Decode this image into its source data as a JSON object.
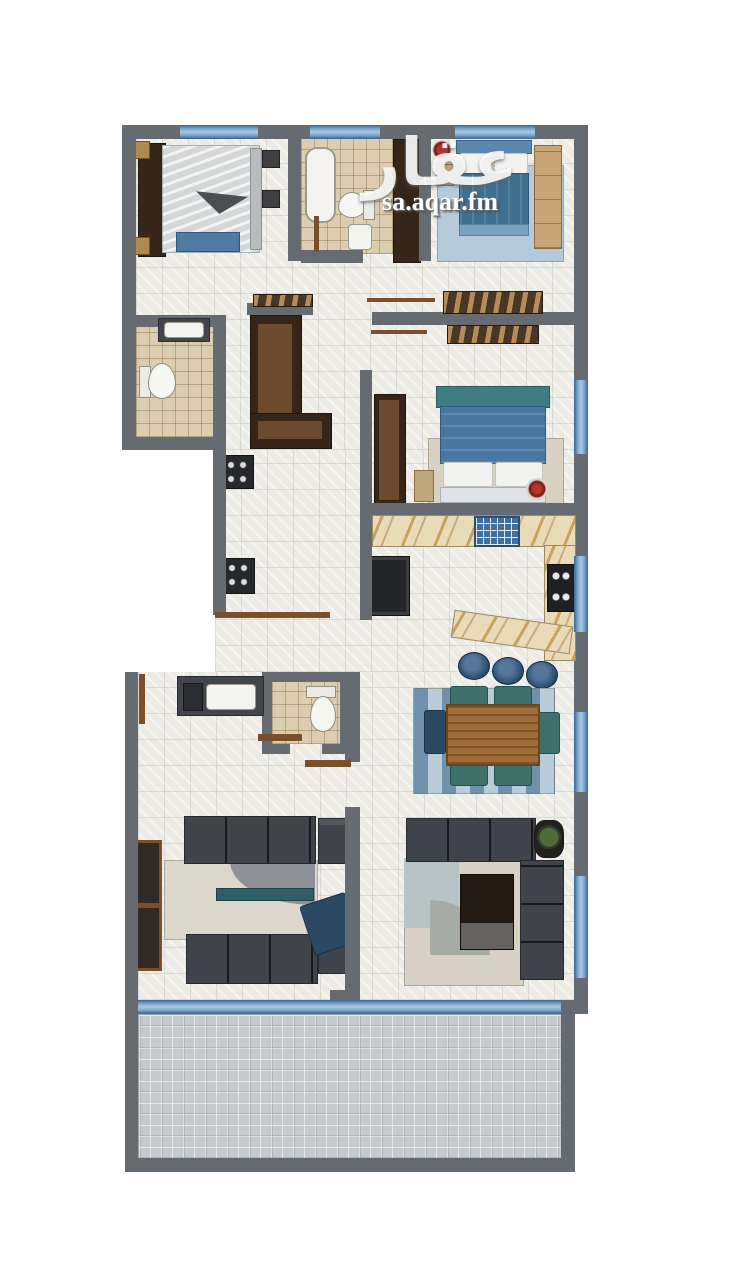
{
  "watermark": {
    "logo": "عقار",
    "site": "sa.aqar.fm"
  },
  "palette": {
    "wall": "#666b72",
    "window_blue": "#4a7cae",
    "floor_tile": "#edebe5",
    "bath_tile": "#dccdb1",
    "marble_counter": "#e9dab8",
    "marble_vein": "#b98a3e",
    "dark_wood": "#352619",
    "door_wood": "#7b4f2a",
    "sofa_gray": "#40444a",
    "bed_blue": "#4878a2",
    "teal": "#3e706c",
    "stool_navy": "#2c4a66",
    "terrace_paver": "#c7cacd",
    "background": "#ffffff"
  },
  "rooms": [
    {
      "name": "bedroom-top-left",
      "items": [
        "wardrobe",
        "double-bed",
        "blue-bench",
        "nightstands"
      ]
    },
    {
      "name": "bathroom-top",
      "items": [
        "bathtub",
        "toilet",
        "washbasin"
      ]
    },
    {
      "name": "bedroom-top-right",
      "items": [
        "double-bed",
        "wardrobe",
        "rug",
        "red-plant"
      ]
    },
    {
      "name": "hallway",
      "items": [
        "console-table",
        "console-table",
        "door-swings"
      ]
    },
    {
      "name": "bathroom-left",
      "items": [
        "toilet",
        "vanity-basin"
      ]
    },
    {
      "name": "dressing-closet",
      "items": [
        "l-shaped-wardrobe"
      ]
    },
    {
      "name": "laundry-nook",
      "items": [
        "washer",
        "dryer"
      ]
    },
    {
      "name": "bedroom-middle",
      "items": [
        "double-bed",
        "wardrobe",
        "rug",
        "red-plant"
      ]
    },
    {
      "name": "kitchen",
      "items": [
        "marble-counter",
        "sink",
        "cooktop",
        "fridge",
        "island-bar",
        "bar-stool",
        "bar-stool",
        "bar-stool"
      ]
    },
    {
      "name": "dining-area",
      "items": [
        "wood-table",
        "six-chairs",
        "blue-rug"
      ]
    },
    {
      "name": "guest-bathroom",
      "items": [
        "toilet",
        "double-vanity"
      ]
    },
    {
      "name": "majlis",
      "items": [
        "sofa",
        "sofa",
        "armchair",
        "armchair",
        "coffee-table",
        "rug"
      ]
    },
    {
      "name": "living-room",
      "items": [
        "sectional-sofa",
        "coffee-table",
        "rug",
        "plant"
      ]
    },
    {
      "name": "terrace",
      "items": [
        "paved-floor"
      ]
    }
  ]
}
